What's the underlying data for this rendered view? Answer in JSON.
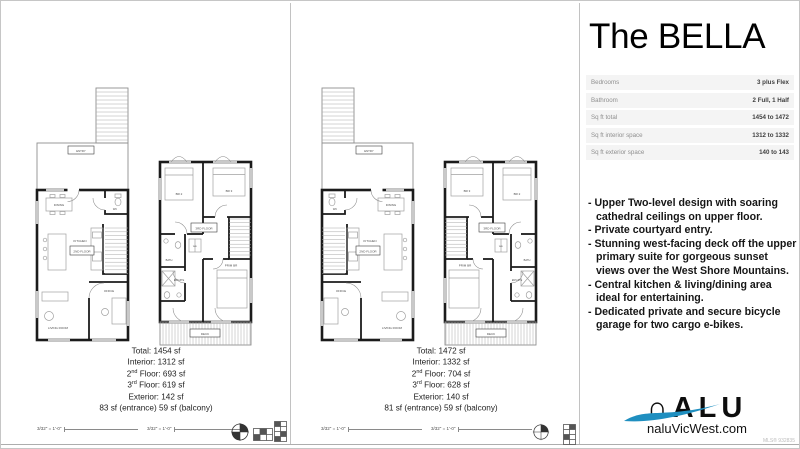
{
  "title": "The BELLA",
  "specs": [
    {
      "label": "Bedrooms",
      "value": "3 plus Flex"
    },
    {
      "label": "Bathroom",
      "value": "2 Full, 1 Half"
    },
    {
      "label": "Sq ft total",
      "value": "1454 to 1472"
    },
    {
      "label": "Sq ft interior space",
      "value": "1312 to 1332"
    },
    {
      "label": "Sq ft exterior space",
      "value": "140 to 143"
    }
  ],
  "features": [
    "- Upper Two-level design with soaring cathedral ceilings on upper floor.",
    "- Private courtyard entry.",
    "- Stunning west-facing deck off the upper primary suite for gorgeous sunset views over the West Shore Mountains.",
    "- Central kitchen & living/dining area ideal for entertaining.",
    "- Dedicated private and secure bicycle garage for two cargo e-bikes."
  ],
  "plan_a": {
    "totals": [
      {
        "pre": "Total: 1454 sf",
        "sup": "",
        "post": ""
      },
      {
        "pre": "Interior: 1312 sf",
        "sup": "",
        "post": ""
      },
      {
        "pre": "2",
        "sup": "nd",
        "post": " Floor: 693 sf"
      },
      {
        "pre": "3",
        "sup": "rd",
        "post": " Floor: 619 sf"
      },
      {
        "pre": "Exterior: 142 sf",
        "sup": "",
        "post": ""
      },
      {
        "pre": "83 sf (entrance) 59 sf (balcony)",
        "sup": "",
        "post": ""
      }
    ]
  },
  "plan_b": {
    "totals": [
      {
        "pre": "Total: 1472 sf",
        "sup": "",
        "post": ""
      },
      {
        "pre": "Interior: 1332 sf",
        "sup": "",
        "post": ""
      },
      {
        "pre": "2",
        "sup": "nd",
        "post": " Floor: 704 sf"
      },
      {
        "pre": "3",
        "sup": "rd",
        "post": " Floor: 628 sf"
      },
      {
        "pre": "Exterior: 140 sf",
        "sup": "",
        "post": ""
      },
      {
        "pre": "81 sf (entrance) 59 sf (balcony)",
        "sup": "",
        "post": ""
      }
    ]
  },
  "rooms": {
    "lower": {
      "entry": "ENTRY",
      "dining": "DINING",
      "wc": "WC",
      "kitchen": "KITCHEN",
      "level": "2ND FLOOR",
      "living": "LIVING ROOM",
      "office": "OFFICE"
    },
    "upper": {
      "br2": "BR 2",
      "br3": "BR 3",
      "wd": "W/D",
      "bath": "BATH",
      "ensuite": "ENSUITE",
      "prim": "PRIM BR",
      "level": "3RD FLOOR",
      "deck": "DECK"
    }
  },
  "scale": {
    "text": "3/32\" = 1'-0\""
  },
  "logo": {
    "wordmark": "∩ALU",
    "site": "naluVicWest.com",
    "mls": "MLS® 932835"
  },
  "colors": {
    "accent": "#1f8fc0",
    "wall": "#1a1a1a"
  }
}
